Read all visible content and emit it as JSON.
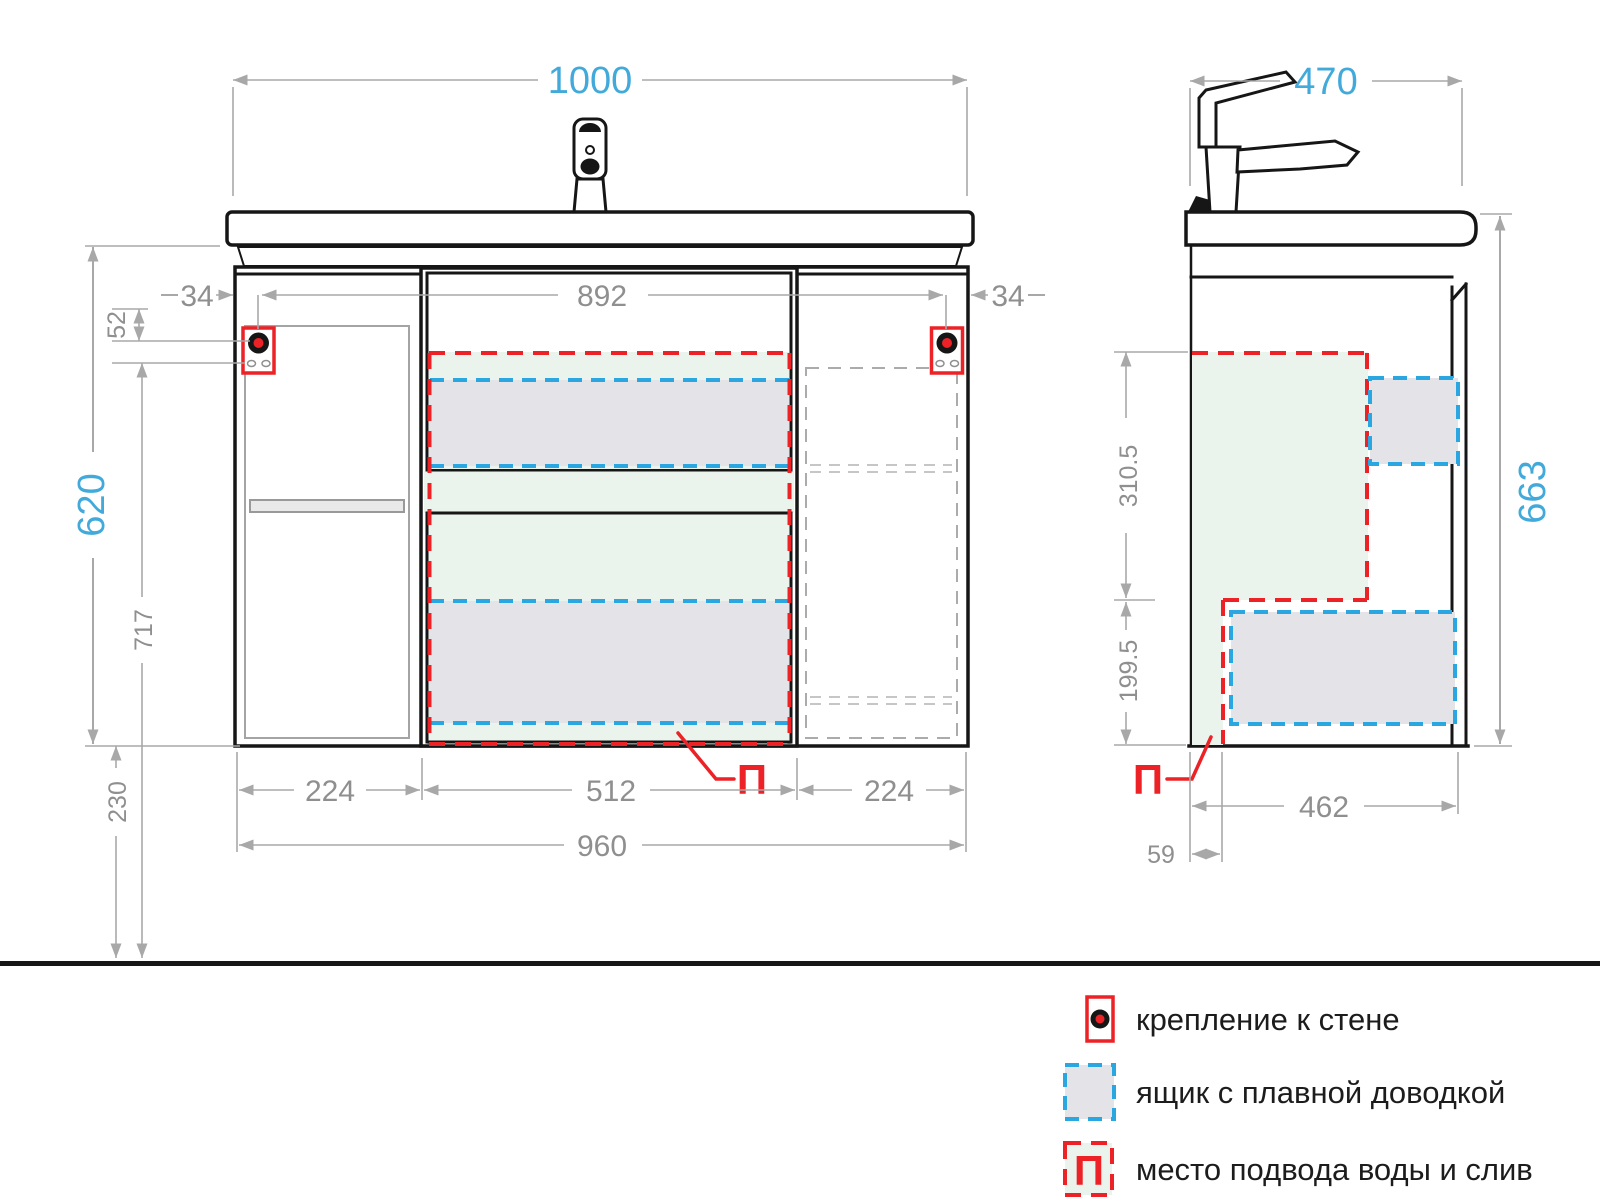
{
  "front_view": {
    "dim_total_width": "1000",
    "dim_inner_width": "892",
    "dim_side_offset_left": "34",
    "dim_side_offset_right": "34",
    "dim_fastener_offset": "52",
    "dim_cabinet_height": "620",
    "dim_fastener_to_floor": "717",
    "dim_floor_clearance": "230",
    "dim_left_door_width": "224",
    "dim_drawer_width": "512",
    "dim_right_door_width": "224",
    "dim_cabinet_width": "960",
    "water_point_label": "П"
  },
  "side_view": {
    "dim_depth": "470",
    "dim_total_height": "663",
    "dim_upper_zone_height": "310.5",
    "dim_lower_zone_height": "199.5",
    "dim_inner_depth": "462",
    "dim_back_offset": "59",
    "water_point_label": "П"
  },
  "legend": {
    "wall_mount_label": "крепление к стене",
    "soft_close_label": "ящик с плавной доводкой",
    "water_supply_label": "место подвода воды и слив",
    "water_symbol": "П"
  },
  "colors": {
    "dim_blue": "#41aadb",
    "dim_gray": "#8f8f8f",
    "accent_red": "#ec2227",
    "drawer_blue": "#2aa7e0",
    "zone_green": "#ebf4ec",
    "drawer_gray": "#e4e4e8"
  }
}
